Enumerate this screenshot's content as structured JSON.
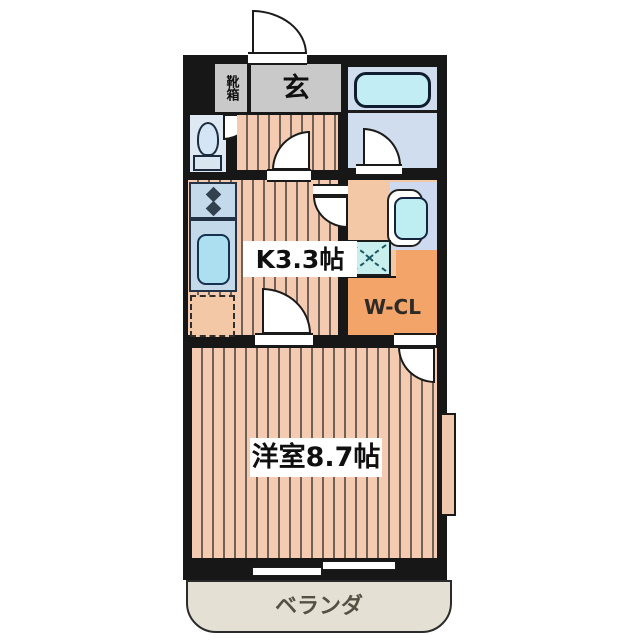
{
  "type": "japanese-apartment-floor-plan",
  "rooms": {
    "shoe_cabinet": {
      "label": "靴箱"
    },
    "entrance": {
      "label": "玄"
    },
    "kitchen": {
      "label": "K3.3帖"
    },
    "walk_in_closet": {
      "label": "W-CL"
    },
    "western_room": {
      "label": "洋室8.7帖"
    },
    "veranda": {
      "label": "ベランダ"
    }
  },
  "fixtures": {
    "bathtub": "bathtub-icon",
    "toilet": "toilet-icon",
    "stove": "stove-burners-icon",
    "kitchen_sink": "kitchen-sink-icon",
    "refrigerator_space": "refrigerator-outline-icon",
    "washbasin": "washbasin-icon",
    "washing_machine_pan": "washing-machine-pan-icon",
    "doors": "door-swing-arc-icon",
    "windows": "sliding-window-icon"
  },
  "colors": {
    "background": "#ffffff",
    "wall": "#171717",
    "floor_plank": "#f4cbb0",
    "floor_plank_line": "#6f6156",
    "entrance_gray": "#c9c9c9",
    "bathroom_floor": "#d0ddee",
    "bathtub_fill": "#c2edf5",
    "closet_orange": "#f2a469",
    "powder_room_floor": "#f3c8a6",
    "washer_pan_fill": "#c8eeee",
    "counter_blue": "#c4daeb",
    "sink_fill": "#ace0f0",
    "veranda_fill": "#e4e0d4"
  }
}
